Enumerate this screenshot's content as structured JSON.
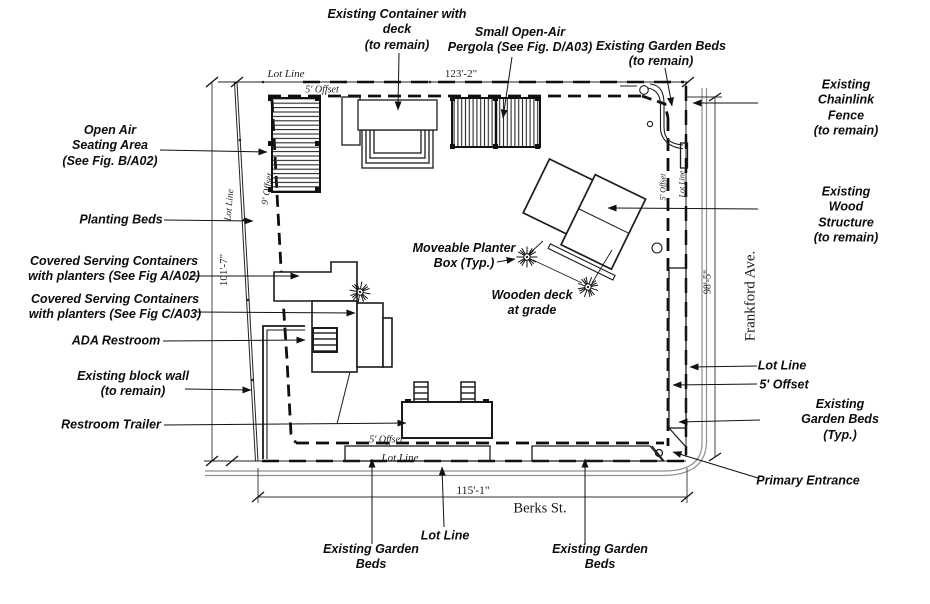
{
  "colors": {
    "ink": "#1a1a1a",
    "paper": "#ffffff",
    "sidewalk": "#8f8f8f"
  },
  "streets": {
    "bottom": "Berks St.",
    "right": "Frankford Ave."
  },
  "dimensions": {
    "top": "123'-2\"",
    "bottom": "115'-1\"",
    "left": "101'-7\"",
    "right": "98'-5\""
  },
  "line_labels": {
    "lot_line": "Lot Line",
    "offset_5": "5' Offset",
    "offset_9": "9' Offset"
  },
  "annotations": {
    "existing_container": "Existing Container with\ndeck\n(to remain)",
    "pergola": "Small Open-Air\nPergola (See Fig. D/A03)",
    "garden_beds_top": "Existing Garden Beds\n(to remain)",
    "chainlink_fence": "Existing Chainlink Fence\n(to remain)",
    "wood_structure": "Existing Wood Structure\n(to remain)",
    "lot_line_right": "Lot Line",
    "offset_right": "5' Offset",
    "garden_beds_right": "Existing Garden Beds (Typ.)",
    "primary_entrance": "Primary Entrance",
    "open_air_seating": "Open Air\nSeating Area\n(See Fig. B/A02)",
    "planting_beds": "Planting Beds",
    "serving_containers_a": "Covered Serving Containers\nwith planters (See Fig A/A02)",
    "serving_containers_c": "Covered Serving Containers\nwith planters (See Fig C/A03)",
    "ada_restroom": "ADA Restroom",
    "block_wall": "Existing block wall\n(to remain)",
    "restroom_trailer": "Restroom Trailer",
    "moveable_planter": "Moveable Planter\nBox (Typ.)",
    "wooden_deck": "Wooden deck\nat grade",
    "lot_line_bottom": "Lot Line",
    "garden_beds_bottom_left": "Existing Garden\nBeds",
    "garden_beds_bottom_right": "Existing Garden\nBeds"
  }
}
